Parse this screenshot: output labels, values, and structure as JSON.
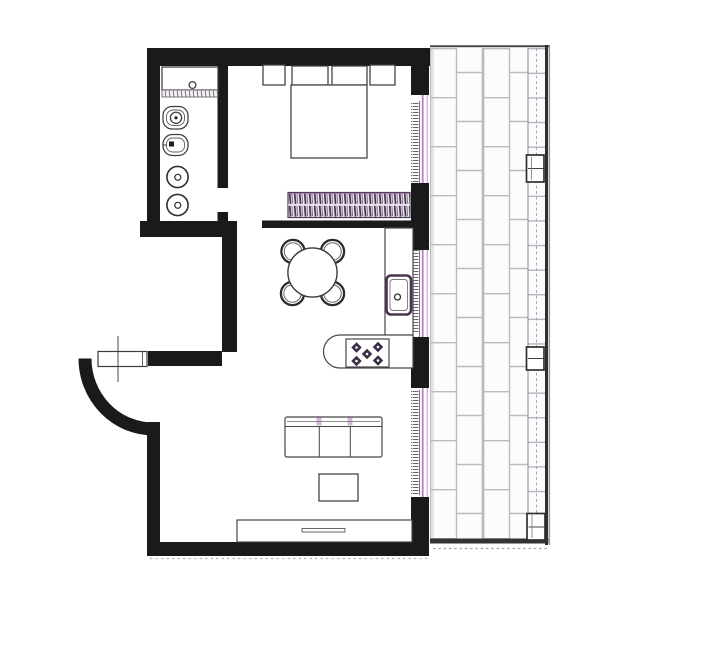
{
  "document": {
    "type": "apartment-floor-plan",
    "visible_text": []
  },
  "colors": {
    "bg": "#ffffff",
    "wall": "#1a1a1a",
    "line": "#3f3f43",
    "purple": "#bb7ec4",
    "purple2": "#d0a6d6",
    "hatch": "#463653",
    "joint": "#beb8c0",
    "border": "#2f2f2f"
  },
  "elements": {
    "bathroom": {
      "fixtures": [
        "vanity-sink",
        "toilet",
        "bidet",
        "round-fixture",
        "round-fixture"
      ]
    },
    "bedroom": {
      "fixtures": [
        "nightstand-left",
        "pillow",
        "pillow",
        "nightstand-right",
        "double-bed",
        "hatched-wardrobe-radiator"
      ]
    },
    "kitchen_dining": {
      "fixtures": [
        "round-dining-table",
        "chair",
        "chair",
        "chair",
        "chair",
        "counter-with-sink",
        "counter-with-cooktop",
        "five-burner-cooktop"
      ]
    },
    "living_room": {
      "fixtures": [
        "three-seat-sofa",
        "coffee-table",
        "sideboard"
      ]
    },
    "entry": {
      "features": [
        "curved-wall",
        "door-leaf",
        "axis-centerline"
      ]
    },
    "terrace": {
      "features": [
        "brick-paving",
        "edge-tile-strip",
        "edge-post",
        "edge-post",
        "edge-post"
      ]
    },
    "window_openings_count": 3
  }
}
